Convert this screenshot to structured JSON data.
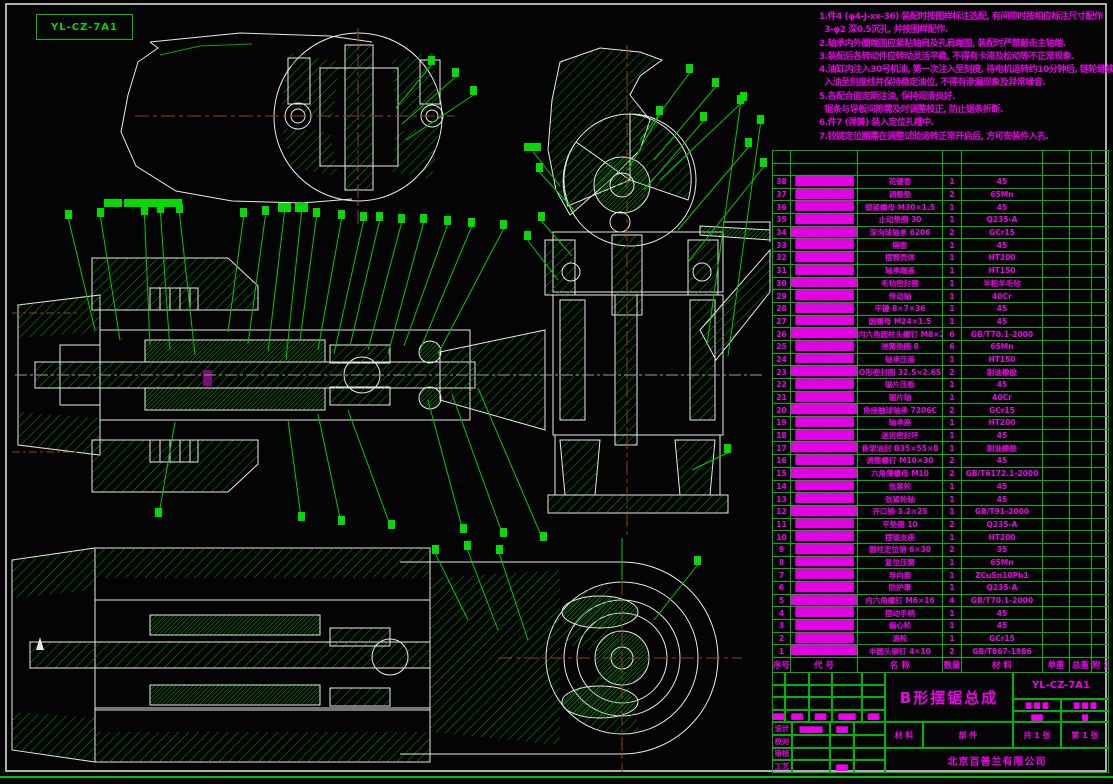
{
  "drawing": {
    "border_label": "YL-CZ-7A1",
    "notes_lines": [
      "1.件4 (φ4-J-xx-36) 装配时按图样标注选配, 有间隙时按相应标注尺寸配作",
      "  3-φ2 深0.5沉孔, 并按图样配作.",
      "2.轴承内外圈端面应紧贴轴肩及孔肩端面, 装配时严禁敲击主轴端.",
      "3.装配后各转动件应转动灵活平稳, 不得有卡滞及松动等不正常现象.",
      "4.油缸内注入30号机油, 第一次注入至刻度, 待电机运转约10分钟后, 链轮继续转动, 再",
      "  入油至刻度线并保持稳定油位, 不得有渗漏现象及异常噪音.",
      "5.各配合面定期注油, 保持润滑良好.",
      "  锯条与导板间隙需及时调整校正, 防止锯条折断.",
      "6.件7 (弹簧) 装入定位孔槽中.",
      "7.铰链定位圈需在调整试验运转正常开启后, 方可安装件入孔."
    ],
    "colors": {
      "outline": "#e8e8e8",
      "hatch_green": "#00a800",
      "leader_green": "#00d800",
      "magenta": "#ee00ee",
      "grid_green": "#00b400",
      "centerline_brown": "#8b4513",
      "detail_purple": "#7a0b7a"
    }
  },
  "bom": {
    "headers": [
      "序号",
      "代 号",
      "名 称",
      "数量",
      "材 料",
      "单重",
      "总重",
      "附 注"
    ],
    "rows": [
      {
        "seq": "38",
        "code": "██████████",
        "name": "花键套",
        "qty": "1",
        "material": "45"
      },
      {
        "seq": "37",
        "code": "██████████",
        "name": "调整垫",
        "qty": "2",
        "material": "65Mn"
      },
      {
        "seq": "36",
        "code": "██████████",
        "name": "锁紧螺母 M30×1.5",
        "qty": "1",
        "material": "45"
      },
      {
        "seq": "35",
        "code": "██████████",
        "name": "止动垫圈 30",
        "qty": "1",
        "material": "Q235-A"
      },
      {
        "seq": "34",
        "code": "█████████████",
        "name": "深沟球轴承 6206",
        "qty": "2",
        "material": "GCr15"
      },
      {
        "seq": "33",
        "code": "██████████",
        "name": "隔套",
        "qty": "1",
        "material": "45"
      },
      {
        "seq": "32",
        "code": "██████████",
        "name": "摆臂壳体",
        "qty": "1",
        "material": "HT200"
      },
      {
        "seq": "31",
        "code": "██████████",
        "name": "轴承端盖",
        "qty": "1",
        "material": "HT150"
      },
      {
        "seq": "30",
        "code": "█████████████",
        "name": "毛毡密封圈",
        "qty": "1",
        "material": "半粗羊毛毡"
      },
      {
        "seq": "29",
        "code": "██████████",
        "name": "传动轴",
        "qty": "1",
        "material": "40Cr"
      },
      {
        "seq": "28",
        "code": "██████████",
        "name": "平键 8×7×36",
        "qty": "1",
        "material": "45"
      },
      {
        "seq": "27",
        "code": "██████████",
        "name": "圆螺母 M24×1.5",
        "qty": "1",
        "material": "45"
      },
      {
        "seq": "26",
        "code": "██████████████",
        "name": "内六角圆柱头螺钉 M8×25",
        "qty": "6",
        "material": "GB/T70.1-2000"
      },
      {
        "seq": "25",
        "code": "██████████",
        "name": "弹簧垫圈 8",
        "qty": "6",
        "material": "65Mn"
      },
      {
        "seq": "24",
        "code": "██████████",
        "name": "轴承压盖",
        "qty": "1",
        "material": "HT150"
      },
      {
        "seq": "23",
        "code": "█████████████",
        "name": "O形密封圈 32.5×2.65",
        "qty": "2",
        "material": "耐油橡胶"
      },
      {
        "seq": "22",
        "code": "██████████",
        "name": "锯片压板",
        "qty": "1",
        "material": "45"
      },
      {
        "seq": "21",
        "code": "██████████",
        "name": "锯片轴",
        "qty": "1",
        "material": "40Cr"
      },
      {
        "seq": "20",
        "code": "█████████████",
        "name": "角接触球轴承 7206C",
        "qty": "2",
        "material": "GCr15"
      },
      {
        "seq": "19",
        "code": "██████████",
        "name": "轴承座",
        "qty": "1",
        "material": "HT200"
      },
      {
        "seq": "18",
        "code": "██████████",
        "name": "迷宫密封环",
        "qty": "1",
        "material": "45"
      },
      {
        "seq": "17",
        "code": "█████████████",
        "name": "骨架油封 B35×55×8",
        "qty": "1",
        "material": "耐油橡胶"
      },
      {
        "seq": "16",
        "code": "██████████",
        "name": "调整螺钉 M10×30",
        "qty": "2",
        "material": "45"
      },
      {
        "seq": "15",
        "code": "██████████████",
        "name": "六角薄螺母 M10",
        "qty": "2",
        "material": "GB/T6172.1-2000"
      },
      {
        "seq": "14",
        "code": "██████████",
        "name": "张紧轮",
        "qty": "1",
        "material": "45"
      },
      {
        "seq": "13",
        "code": "██████████",
        "name": "张紧轮轴",
        "qty": "1",
        "material": "45"
      },
      {
        "seq": "12",
        "code": "██████████████",
        "name": "开口销 3.2×25",
        "qty": "1",
        "material": "GB/T91-2000"
      },
      {
        "seq": "11",
        "code": "██████████",
        "name": "平垫圈 10",
        "qty": "2",
        "material": "Q235-A"
      },
      {
        "seq": "10",
        "code": "██████████",
        "name": "摆锯支座",
        "qty": "1",
        "material": "HT200"
      },
      {
        "seq": "9",
        "code": "██████████",
        "name": "圆柱定位销 6×30",
        "qty": "2",
        "material": "35"
      },
      {
        "seq": "8",
        "code": "██████████",
        "name": "复位压簧",
        "qty": "1",
        "material": "65Mn"
      },
      {
        "seq": "7",
        "code": "██████████",
        "name": "导向套",
        "qty": "1",
        "material": "ZCuSn10Pb1"
      },
      {
        "seq": "6",
        "code": "██████████",
        "name": "防护罩",
        "qty": "1",
        "material": "Q235-A"
      },
      {
        "seq": "5",
        "code": "██████████████",
        "name": "内六角螺钉 M6×16",
        "qty": "4",
        "material": "GB/T70.1-2000"
      },
      {
        "seq": "4",
        "code": "██████████",
        "name": "摆动手柄",
        "qty": "1",
        "material": "45"
      },
      {
        "seq": "3",
        "code": "██████████",
        "name": "偏心轮",
        "qty": "1",
        "material": "45"
      },
      {
        "seq": "2",
        "code": "██████████",
        "name": "滚轮",
        "qty": "1",
        "material": "GCr15"
      },
      {
        "seq": "1",
        "code": "██████████████",
        "name": "半圆头铆钉 4×10",
        "qty": "2",
        "material": "GB/T867-1986"
      }
    ]
  },
  "title_block": {
    "title": "B形摆锯总成",
    "drawing_no": "YL-CZ-7A1",
    "material_label": "材 料",
    "part_label": "部 件",
    "sheets_total": "共 1 张",
    "sheet_no": "第 1 张",
    "company": "北京百普兰有限公司",
    "rev_blocks": [
      "▆▆",
      "▆▆",
      "▆▆",
      "▆▆▆",
      "▆▆"
    ],
    "stage_blocks": [
      [
        "▆ ▆ ▆",
        "▆ ▆ ▆"
      ],
      [
        "▆▆",
        "▆"
      ]
    ],
    "sig_rows": [
      {
        "label": "设计",
        "b1": "▆▆▆▆",
        "b2": "▆▆"
      },
      {
        "label": "校对",
        "b1": "",
        "b2": ""
      },
      {
        "label": "审核",
        "b1": "",
        "b2": ""
      },
      {
        "label": "工艺",
        "b1": "",
        "b2": "▆▆"
      }
    ]
  }
}
